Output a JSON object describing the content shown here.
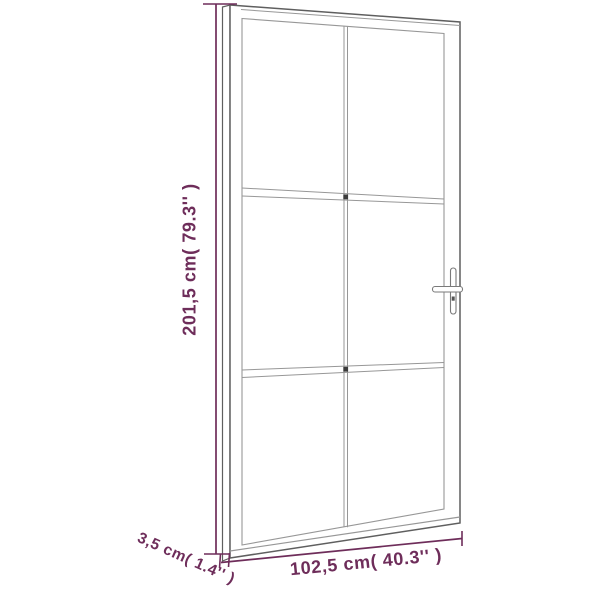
{
  "colors": {
    "accent": "#6e2d5a",
    "line": "#5f5f5f",
    "line_light": "#979797",
    "bg": "#ffffff"
  },
  "diagram": {
    "subject": "interior-glass-door",
    "panes": {
      "rows": 3,
      "cols": 2
    },
    "dimensions": {
      "height": {
        "label": "201,5 cm( 79.3'' )"
      },
      "width": {
        "label": "102,5 cm( 40.3'' )"
      },
      "thickness": {
        "label": "3,5 cm( 1.4'' )"
      }
    }
  }
}
